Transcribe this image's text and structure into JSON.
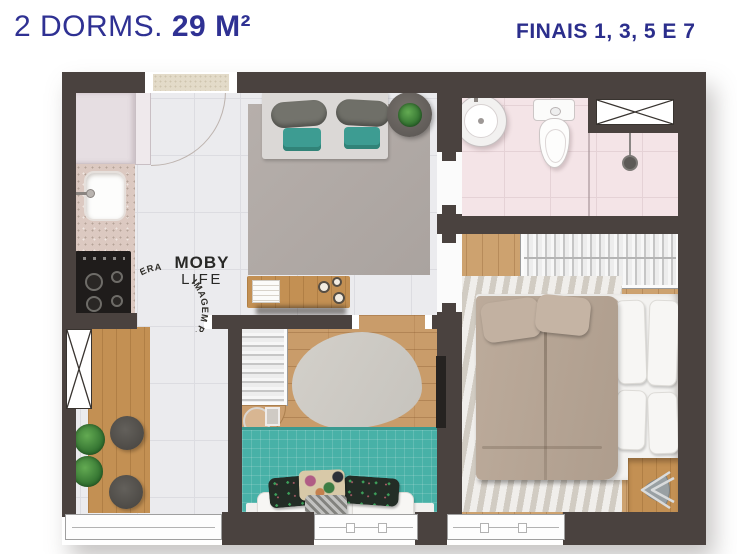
{
  "header": {
    "dorms_label": "2 DORMS. ",
    "area_value": "29 M²",
    "finals_label": "FINAIS 1, 3, 5 E 7"
  },
  "watermark": {
    "brand_line1": "MOBY",
    "brand_line2": "LIFE",
    "circular_text": "IMAGEM PRELIMINAR E SUJEITA A ALTERAÇÕES."
  },
  "colors": {
    "title_navy": "#2f3193",
    "wall_dark": "#4a423f",
    "teal_accent": "#47b0a6",
    "wood_floor": "#c99c6a",
    "bathroom_pink": "#f4e4e7",
    "tile_gray": "#ebebee",
    "duvet_taupe": "#b6a595"
  }
}
